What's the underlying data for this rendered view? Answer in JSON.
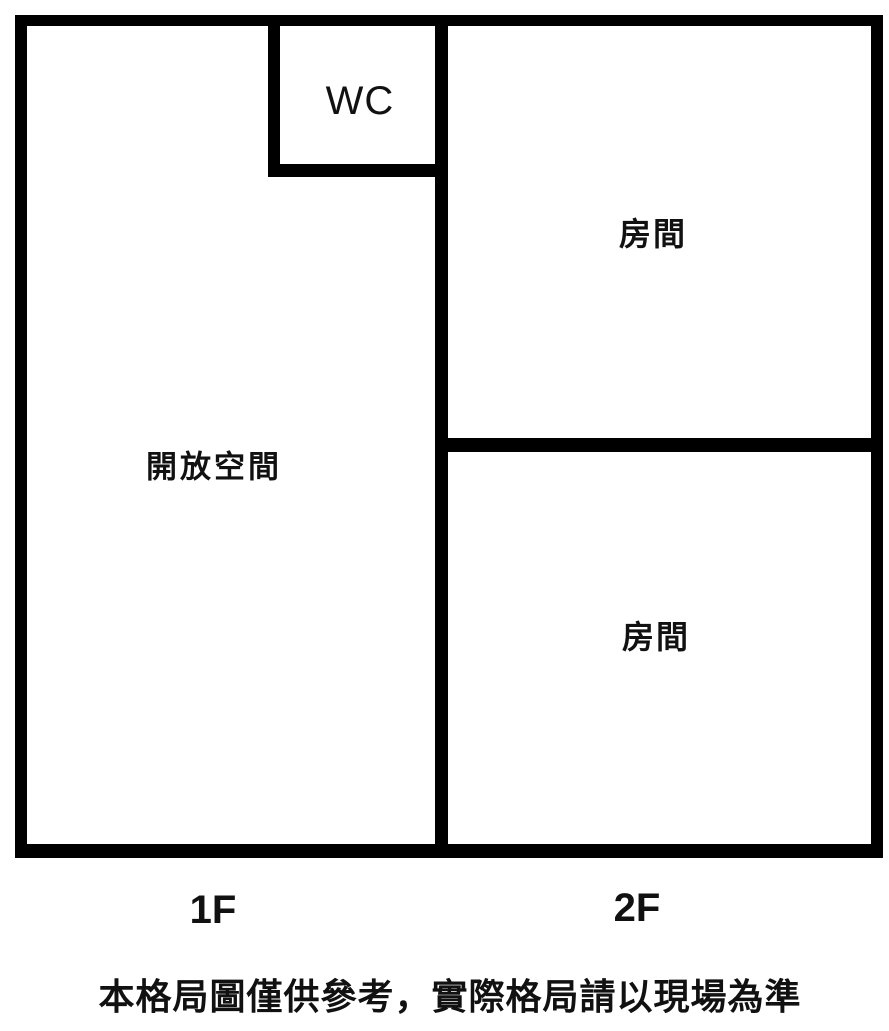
{
  "floor_plan": {
    "rooms": [
      {
        "id": "open-space",
        "label": "開放空間"
      },
      {
        "id": "wc",
        "label": "WC"
      },
      {
        "id": "room-2f-top",
        "label": "房間"
      },
      {
        "id": "room-2f-bottom",
        "label": "房間"
      }
    ],
    "floor_labels": [
      {
        "id": "1f",
        "label": "1F"
      },
      {
        "id": "2f",
        "label": "2F"
      }
    ],
    "disclaimer": "本格局圖僅供參考，實際格局請以現場為準",
    "colors": {
      "wall": "#000000",
      "background": "#ffffff",
      "text": "#111111"
    }
  }
}
